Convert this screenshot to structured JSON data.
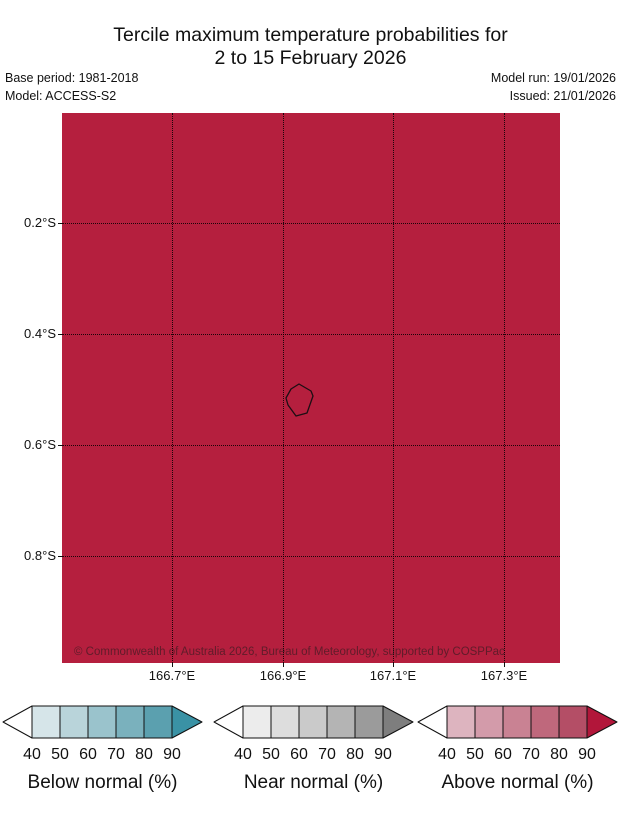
{
  "title": {
    "line1": "Tercile maximum temperature probabilities for",
    "line2": "2 to 15 February 2026"
  },
  "meta": {
    "base_period": "Base period: 1981-2018",
    "model": "Model: ACCESS-S2",
    "model_run": "Model run: 19/01/2026",
    "issued": "Issued: 21/01/2026"
  },
  "map": {
    "fill_color": "#b51f3e",
    "grid_color": "#000000",
    "x_tick_labels": [
      "166.7°E",
      "166.9°E",
      "167.1°E",
      "167.3°E"
    ],
    "y_tick_labels": [
      "0.2°S",
      "0.4°S",
      "0.6°S",
      "0.8°S"
    ],
    "copyright": "© Commonwealth of Australia 2026, Bureau of Meteorology, supported by COSPPac"
  },
  "legends": [
    {
      "id": "below-normal",
      "label": "Below normal (%)",
      "tick_labels": [
        "40",
        "50",
        "60",
        "70",
        "80",
        "90"
      ],
      "low_arrow_color": "#ffffff",
      "segment_colors": [
        "#d6e5e9",
        "#b9d4da",
        "#9ac3cc",
        "#7ab1bd",
        "#5ba0af"
      ],
      "arrow_color": "#3a92a5"
    },
    {
      "id": "near-normal",
      "label": "Near normal (%)",
      "tick_labels": [
        "40",
        "50",
        "60",
        "70",
        "80",
        "90"
      ],
      "low_arrow_color": "#ffffff",
      "segment_colors": [
        "#ececec",
        "#dddddd",
        "#cacaca",
        "#b4b4b4",
        "#9b9b9b"
      ],
      "arrow_color": "#7e7e7e"
    },
    {
      "id": "above-normal",
      "label": "Above normal (%)",
      "tick_labels": [
        "40",
        "50",
        "60",
        "70",
        "80",
        "90"
      ],
      "low_arrow_color": "#ffffff",
      "segment_colors": [
        "#ddb4bf",
        "#d39baa",
        "#c98293",
        "#bf687c",
        "#b44e66"
      ],
      "arrow_color": "#b2163a"
    }
  ]
}
